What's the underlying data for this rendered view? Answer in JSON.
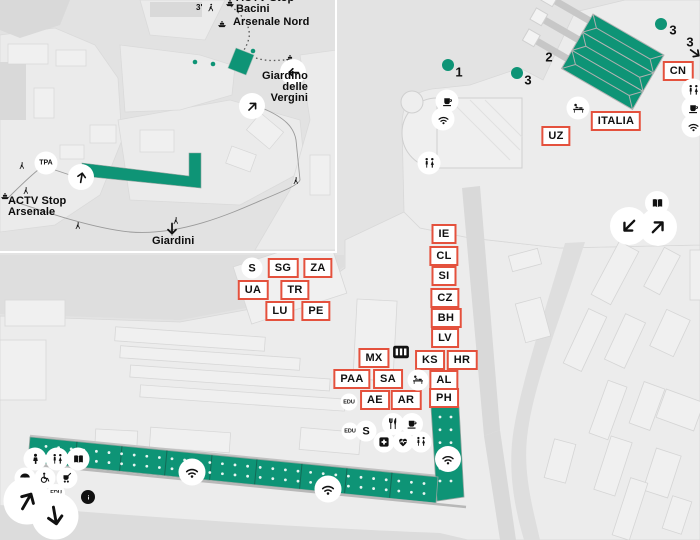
{
  "map_title": "Biennale Arsenale venue map",
  "colors": {
    "pavilion_green": "#0e9476",
    "label_red": "#e4513d",
    "ink": "#111111",
    "water": "#e3e3e3"
  },
  "inset": {
    "labels": [
      {
        "id": "actv-stop-bacini",
        "text": "ACTV Stop\nBacini",
        "x": 236,
        "y": -7,
        "align": "left",
        "small": false
      },
      {
        "id": "walk-time",
        "text": "3'",
        "x": 196,
        "y": 4,
        "align": "left",
        "small": true
      },
      {
        "id": "arsenale-nord",
        "text": "Arsenale Nord",
        "x": 233,
        "y": 17,
        "align": "left",
        "small": false
      },
      {
        "id": "giardino-delle-vergini",
        "text": "Giardino\ndelle\nVergini",
        "x": 308,
        "y": 71,
        "align": "right",
        "small": false
      },
      {
        "id": "actv-stop-arsenale",
        "text": "ACTV Stop\nArsenale",
        "x": 8,
        "y": 196,
        "align": "left",
        "small": false
      },
      {
        "id": "giardini",
        "text": "Giardini",
        "x": 152,
        "y": 236,
        "align": "left",
        "small": false
      }
    ],
    "badges": [
      {
        "label": "TPA",
        "x": 46,
        "y": 163,
        "d": 23,
        "fs": 7
      }
    ],
    "icons": [
      {
        "type": "ferry",
        "x": 230,
        "y": 3,
        "d": 11
      },
      {
        "type": "walker",
        "x": 211,
        "y": 8,
        "d": 10
      },
      {
        "type": "ferry",
        "x": 222,
        "y": 24,
        "d": 11
      },
      {
        "type": "ferry",
        "x": 290,
        "y": 58,
        "d": 11
      },
      {
        "type": "ferry",
        "x": 5,
        "y": 196,
        "d": 11
      },
      {
        "type": "walker",
        "x": 22,
        "y": 166,
        "d": 9
      },
      {
        "type": "walker",
        "x": 26,
        "y": 191,
        "d": 9
      },
      {
        "type": "walker",
        "x": 78,
        "y": 226,
        "d": 9
      },
      {
        "type": "walker",
        "x": 176,
        "y": 221,
        "d": 9
      },
      {
        "type": "walker",
        "x": 296,
        "y": 181,
        "d": 9
      }
    ],
    "arrows": [
      {
        "x": 81,
        "y": 177,
        "d": 26,
        "angle": 10,
        "circle": true,
        "name": "route-arrow-up"
      },
      {
        "x": 252,
        "y": 106,
        "d": 26,
        "angle": 45,
        "circle": true,
        "name": "route-arrow-ne"
      },
      {
        "x": 293,
        "y": 72,
        "d": 26,
        "angle": 270,
        "circle": true,
        "name": "route-arrow-left"
      },
      {
        "x": 172,
        "y": 229,
        "d": 16,
        "angle": 180,
        "circle": false,
        "name": "giardini-arrow-down"
      }
    ]
  },
  "main": {
    "pavilion_tags": [
      {
        "label": "CN",
        "x": 678,
        "y": 71
      },
      {
        "label": "ITALIA",
        "x": 616,
        "y": 121
      },
      {
        "label": "UZ",
        "x": 556,
        "y": 136
      },
      {
        "label": "IE",
        "x": 444,
        "y": 234
      },
      {
        "label": "CL",
        "x": 444,
        "y": 256
      },
      {
        "label": "SI",
        "x": 444,
        "y": 276
      },
      {
        "label": "CZ",
        "x": 445,
        "y": 298
      },
      {
        "label": "BH",
        "x": 446,
        "y": 318
      },
      {
        "label": "LV",
        "x": 445,
        "y": 338
      },
      {
        "label": "KS",
        "x": 430,
        "y": 360
      },
      {
        "label": "HR",
        "x": 462,
        "y": 360
      },
      {
        "label": "AL",
        "x": 444,
        "y": 380
      },
      {
        "label": "PH",
        "x": 444,
        "y": 398
      },
      {
        "label": "SG",
        "x": 283,
        "y": 268
      },
      {
        "label": "ZA",
        "x": 318,
        "y": 268
      },
      {
        "label": "UA",
        "x": 253,
        "y": 290
      },
      {
        "label": "TR",
        "x": 295,
        "y": 290
      },
      {
        "label": "LU",
        "x": 280,
        "y": 311
      },
      {
        "label": "PE",
        "x": 316,
        "y": 311
      },
      {
        "label": "MX",
        "x": 374,
        "y": 358
      },
      {
        "label": "PAA",
        "x": 352,
        "y": 379
      },
      {
        "label": "SA",
        "x": 388,
        "y": 379
      },
      {
        "label": "AE",
        "x": 375,
        "y": 400
      },
      {
        "label": "AR",
        "x": 406,
        "y": 400
      }
    ],
    "badges": [
      {
        "label": "S",
        "x": 252,
        "y": 268,
        "d": 21,
        "fs": 11
      },
      {
        "label": "EDU",
        "x": 349,
        "y": 402,
        "d": 17,
        "fs": 5.5
      },
      {
        "label": "EDU",
        "x": 350,
        "y": 431,
        "d": 17,
        "fs": 5.5
      },
      {
        "label": "S",
        "x": 366,
        "y": 431,
        "d": 21,
        "fs": 11
      },
      {
        "label": "EDU",
        "x": 56,
        "y": 493,
        "d": 18,
        "fs": 5.5
      }
    ],
    "site_numbers": [
      {
        "label": "1",
        "x": 459,
        "y": 72,
        "dot_x": 448,
        "dot_y": 65
      },
      {
        "label": "3",
        "x": 528,
        "y": 80,
        "dot_x": 517,
        "dot_y": 73
      },
      {
        "label": "2",
        "x": 549,
        "y": 57
      },
      {
        "label": "3",
        "x": 673,
        "y": 30,
        "dot_x": 661,
        "dot_y": 24
      },
      {
        "label": "3",
        "x": 690,
        "y": 42
      }
    ],
    "icons": [
      {
        "type": "coffee",
        "x": 447,
        "y": 101,
        "d": 23
      },
      {
        "type": "wifi",
        "x": 443,
        "y": 119,
        "d": 23
      },
      {
        "type": "toilets",
        "x": 429,
        "y": 163,
        "d": 23
      },
      {
        "type": "babychange",
        "x": 578,
        "y": 108,
        "d": 23
      },
      {
        "type": "toilets",
        "x": 693,
        "y": 90,
        "d": 23
      },
      {
        "type": "coffee",
        "x": 693,
        "y": 108,
        "d": 23
      },
      {
        "type": "wifi",
        "x": 693,
        "y": 126,
        "d": 23
      },
      {
        "type": "book",
        "x": 657,
        "y": 203,
        "d": 24
      },
      {
        "type": "grid",
        "x": 401,
        "y": 352,
        "d": 20,
        "bare": true
      },
      {
        "type": "babychange",
        "x": 418,
        "y": 380,
        "d": 21
      },
      {
        "type": "restaurant",
        "x": 393,
        "y": 424,
        "d": 22
      },
      {
        "type": "coffee",
        "x": 412,
        "y": 424,
        "d": 22
      },
      {
        "type": "firstaid",
        "x": 384,
        "y": 442,
        "d": 21
      },
      {
        "type": "aed",
        "x": 403,
        "y": 442,
        "d": 21
      },
      {
        "type": "toilets",
        "x": 421,
        "y": 442,
        "d": 21
      },
      {
        "type": "wifi",
        "x": 448,
        "y": 459,
        "d": 26
      },
      {
        "type": "wifi",
        "x": 192,
        "y": 472,
        "d": 27
      },
      {
        "type": "wifi",
        "x": 328,
        "y": 489,
        "d": 27
      },
      {
        "type": "baby",
        "x": 35,
        "y": 459,
        "d": 23
      },
      {
        "type": "toilets",
        "x": 57,
        "y": 459,
        "d": 23
      },
      {
        "type": "book",
        "x": 78,
        "y": 459,
        "d": 23
      },
      {
        "type": "umbrella",
        "x": 25,
        "y": 478,
        "d": 21
      },
      {
        "type": "wheelchair",
        "x": 45,
        "y": 478,
        "d": 21
      },
      {
        "type": "stroller",
        "x": 67,
        "y": 478,
        "d": 21
      },
      {
        "type": "info",
        "x": 88,
        "y": 497,
        "d": 14,
        "dark": true
      }
    ],
    "arrows": [
      {
        "x": 629,
        "y": 226,
        "d": 38,
        "angle": 225,
        "circle": true,
        "name": "exit-arrow-sw"
      },
      {
        "x": 658,
        "y": 227,
        "d": 38,
        "angle": 45,
        "circle": true,
        "name": "exit-arrow-ne"
      },
      {
        "x": 27,
        "y": 501,
        "d": 47,
        "angle": 30,
        "circle": true,
        "name": "entrance-arrow-ne"
      },
      {
        "x": 55,
        "y": 516,
        "d": 47,
        "angle": 170,
        "circle": true,
        "name": "entrance-arrow-down"
      },
      {
        "x": 695,
        "y": 53,
        "d": 16,
        "angle": 125,
        "circle": false,
        "name": "offmap-arrow-se"
      }
    ]
  }
}
